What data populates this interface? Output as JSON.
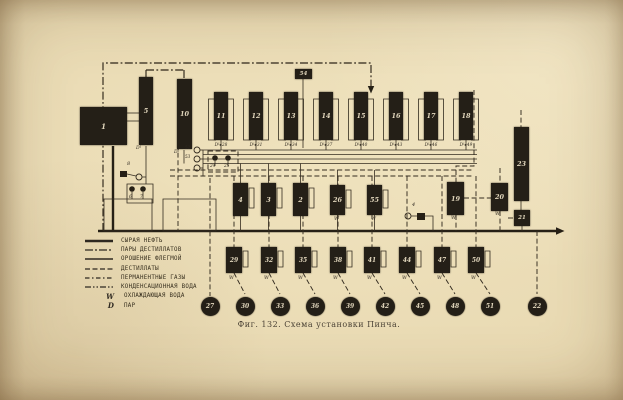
{
  "figure": {
    "caption": "Фиг. 132. Схема установки Пинча."
  },
  "palette": {
    "paper": "#e9dab3",
    "ink": "#2e2820",
    "vessel": "#241f17"
  },
  "furnace": {
    "label": "1"
  },
  "tall_towers": [
    {
      "label": "5",
      "sub": "D¹"
    },
    {
      "label": "10",
      "sub": "D¹"
    }
  ],
  "badge": {
    "label": "54"
  },
  "drain_prefix": "D¹",
  "towers": [
    {
      "label": "11",
      "drain": "28"
    },
    {
      "label": "12",
      "drain": "31"
    },
    {
      "label": "13",
      "drain": "34"
    },
    {
      "label": "14",
      "drain": "37"
    },
    {
      "label": "15",
      "drain": "40"
    },
    {
      "label": "16",
      "drain": "43"
    },
    {
      "label": "17",
      "drain": "46"
    },
    {
      "label": "18",
      "drain": "49"
    }
  ],
  "mid_vessels": [
    {
      "label": "4",
      "w": ""
    },
    {
      "label": "3",
      "w": ""
    },
    {
      "label": "2",
      "w": ""
    },
    {
      "label": "26",
      "w": "W"
    },
    {
      "label": "55",
      "w": "W"
    }
  ],
  "right_units": {
    "column": "23",
    "box19": "19",
    "box20": "20",
    "box21": "21",
    "w_mark": "W"
  },
  "devices": {
    "d4": "4",
    "d6": "6",
    "d7": "7",
    "d8": "8",
    "d24": "24",
    "d25": "25",
    "d52": "52",
    "d53": "53"
  },
  "condensers": [
    {
      "label": "29",
      "w": "W"
    },
    {
      "label": "32",
      "w": "W"
    },
    {
      "label": "35",
      "w": "W"
    },
    {
      "label": "38",
      "w": "W"
    },
    {
      "label": "41",
      "w": "W"
    },
    {
      "label": "44",
      "w": "W"
    },
    {
      "label": "47",
      "w": "W"
    },
    {
      "label": "50",
      "w": "W"
    }
  ],
  "receivers": [
    "27",
    "30",
    "33",
    "36",
    "39",
    "42",
    "45",
    "48",
    "51",
    "22"
  ],
  "legend": [
    {
      "style": "solid-thick",
      "symbol": "",
      "label": "СЫРАЯ НЕФТЬ"
    },
    {
      "style": "dash-dot",
      "symbol": "",
      "label": "ПАРЫ ДЕСТИЛЛАТОВ"
    },
    {
      "style": "solid",
      "symbol": "",
      "label": "ОРОШЕНИЕ ФЛЕГМОЙ"
    },
    {
      "style": "dashed",
      "symbol": "",
      "label": "ДЕСТИЛЛАТЫ"
    },
    {
      "style": "dash-dot-short",
      "symbol": "",
      "label": "ПЕРМАНЕНТНЫЕ ГАЗЫ"
    },
    {
      "style": "dash-dot-dot",
      "symbol": "",
      "label": "КОНДЕНСАЦИОННАЯ ВОДА"
    },
    {
      "style": "letter",
      "symbol": "W",
      "label": "ОХЛАЖДАЮЩАЯ ВОДА"
    },
    {
      "style": "letter",
      "symbol": "D",
      "label": "ПАР"
    }
  ]
}
